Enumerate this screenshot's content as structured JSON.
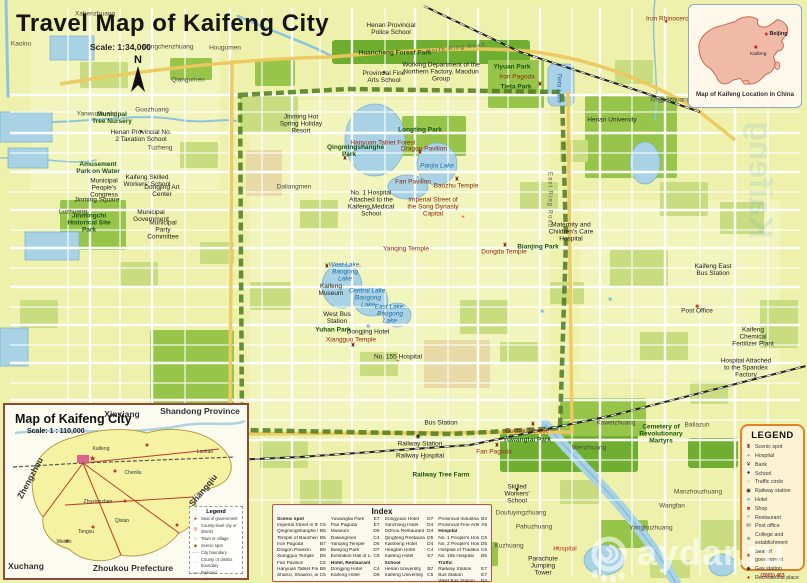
{
  "title": {
    "main": "Travel Map of Kaifeng City",
    "scale": "Scale: 1:34,000",
    "north": "N"
  },
  "china_inset": {
    "caption": "Map of Kaifeng Location in China",
    "beijing": "Beijing",
    "kaifeng": "Kaifeng"
  },
  "city_inset": {
    "title": "Map of Kaifeng City",
    "scale": "Scale: 1 : 110,000",
    "surround": [
      {
        "text": "Xinxiang",
        "x": 122,
        "y": 414
      },
      {
        "text": "Shandong Province",
        "x": 200,
        "y": 411
      },
      {
        "text": "Zhengzhou",
        "x": 30,
        "y": 478,
        "rot": -62
      },
      {
        "text": "Shangqiu",
        "x": 203,
        "y": 490,
        "rot": -50
      },
      {
        "text": "Xuchang",
        "x": 26,
        "y": 566
      },
      {
        "text": "Zhoukou Prefecture",
        "x": 133,
        "y": 568
      }
    ],
    "towns": [
      {
        "text": "Kaifeng",
        "x": 101,
        "y": 449
      },
      {
        "text": "Lankao",
        "x": 205,
        "y": 452
      },
      {
        "text": "Chenliu",
        "x": 133,
        "y": 473
      },
      {
        "text": "Qixian",
        "x": 122,
        "y": 521
      },
      {
        "text": "Tongxu",
        "x": 86,
        "y": 532
      },
      {
        "text": "Weishi",
        "x": 64,
        "y": 542
      },
      {
        "text": "Zhuxianzhen",
        "x": 98,
        "y": 502
      }
    ],
    "legend": {
      "title": "Legend",
      "items": [
        {
          "label": "Seat of government",
          "glyph": "★",
          "color": "#d42c1e"
        },
        {
          "label": "County-level city or district",
          "glyph": "◎",
          "color": "#d42c1e"
        },
        {
          "label": "Town or village",
          "glyph": "○",
          "color": "#555555"
        },
        {
          "label": "Scenic spot",
          "glyph": "◆",
          "color": "#b05a10"
        },
        {
          "label": "City boundary",
          "glyph": "–·–",
          "color": "#888888"
        },
        {
          "label": "County or district boundary",
          "glyph": "···",
          "color": "#888888"
        },
        {
          "label": "Railroad",
          "glyph": "══",
          "color": "#444444"
        },
        {
          "label": "Highway",
          "glyph": "──",
          "color": "#c0392b"
        }
      ]
    }
  },
  "index": {
    "title": "Index",
    "col1": [
      {
        "label": "Scenic spot",
        "cls": "hdr"
      },
      {
        "label": "Imperial Street in the Song Dynasty Capital",
        "ref": "C5"
      },
      {
        "label": "Qingmingshanghe Park",
        "ref": "B5"
      },
      {
        "label": "Temple of Baozheng",
        "ref": "B5"
      },
      {
        "label": "Iron Pagoda",
        "ref": "B7"
      },
      {
        "label": "Dragon Pavilion",
        "ref": "B6"
      },
      {
        "label": "Xiangguo Temple",
        "ref": "D6"
      },
      {
        "label": "Fan Pavilion",
        "ref": "C5"
      },
      {
        "label": "Hanyuan Tablet Forest",
        "ref": "B6"
      },
      {
        "label": "Shanxi, Shaanxi, and Gansu Guild",
        "ref": "C5"
      }
    ],
    "col2": [
      {
        "label": "Yuwangtai Park",
        "ref": "E7"
      },
      {
        "label": "Pan Pagoda",
        "ref": "E7"
      },
      {
        "label": "Museum",
        "ref": "D5"
      },
      {
        "label": "Daliangmen",
        "ref": "C4"
      },
      {
        "label": "Yanqing Temple",
        "ref": "D5"
      },
      {
        "label": "Bianjing Park",
        "ref": "D7"
      },
      {
        "label": "Exhibition Hall of Liu Shaoqi",
        "ref": "C5"
      },
      {
        "label": "Hotel, Restaurant",
        "cls": "hdr"
      },
      {
        "label": "Dongjing Hotel",
        "ref": "C4"
      },
      {
        "label": "Kaifeng Hotel",
        "ref": "D6"
      }
    ],
    "col3": [
      {
        "label": "Dongyuan Hotel",
        "ref": "D7"
      },
      {
        "label": "Yanzhong Hotel",
        "ref": "D4"
      },
      {
        "label": "Dizhou Restaurant",
        "ref": "D4"
      },
      {
        "label": "Qingfeng Restaurant",
        "ref": "D5"
      },
      {
        "label": "Kaisheng Hotel",
        "ref": "D4"
      },
      {
        "label": "Hengfan Hotel",
        "ref": "C4"
      },
      {
        "label": "Kaifeng Hotel",
        "ref": "E7"
      },
      {
        "label": "School",
        "cls": "hdr"
      },
      {
        "label": "Henan University",
        "ref": "B7"
      },
      {
        "label": "Kaifeng University",
        "ref": "C5"
      }
    ],
    "col4": [
      {
        "label": "Provincial Industrial and Commercial School",
        "ref": "B4"
      },
      {
        "label": "Provincial Fine Arts School",
        "ref": "A5"
      },
      {
        "label": "Hospital",
        "cls": "hdr"
      },
      {
        "label": "No. 1 People's Hospital",
        "ref": "C6"
      },
      {
        "label": "No. 2 People's Hospital",
        "ref": "D5"
      },
      {
        "label": "Hospital of Traditional Chinese Medicine",
        "ref": "C6"
      },
      {
        "label": "No. 155 Hospital",
        "ref": "B5"
      },
      {
        "label": "Traffic",
        "cls": "hdr"
      },
      {
        "label": "Railway Station",
        "ref": "E7"
      },
      {
        "label": "Bus Station",
        "ref": "E7"
      },
      {
        "label": "West Bus Station",
        "ref": "D4"
      }
    ]
  },
  "legend": {
    "title": "LEGEND",
    "items": [
      {
        "label": "Scenic spot",
        "glyph": "♜",
        "color": "#8a3318"
      },
      {
        "label": "Hospital",
        "glyph": "+",
        "color": "#d43c2a"
      },
      {
        "label": "Bank",
        "glyph": "¥",
        "color": "#222222"
      },
      {
        "label": "School",
        "glyph": "●",
        "color": "#222222"
      },
      {
        "label": "Traffic circle",
        "glyph": "○",
        "color": "#a8b83a"
      },
      {
        "label": "Railway station",
        "glyph": "◉",
        "color": "#222222"
      },
      {
        "label": "Hotel",
        "glyph": "■",
        "color": "#8fc0dd"
      },
      {
        "label": "Shop",
        "glyph": "■",
        "color": "#cc3322"
      },
      {
        "label": "Restaurant",
        "glyph": "●",
        "color": "#8fc0dd"
      },
      {
        "label": "Post office",
        "glyph": "✉",
        "color": "#444444"
      },
      {
        "label": "College and establishment",
        "glyph": "■",
        "color": "#999999"
      },
      {
        "label": "Seat of government",
        "glyph": "★",
        "color": "#d42c1e"
      },
      {
        "label": "Gas station",
        "glyph": "◆",
        "color": "#333333"
      },
      {
        "label": "Recreational place",
        "glyph": "●",
        "color": "#d42c1e"
      }
    ],
    "note": "(2001) 463"
  },
  "watermark": {
    "text": "aydar.ru"
  },
  "ghost": {
    "text": "Kaifeng"
  },
  "map_labels": [
    {
      "text": "Huancheng Forest Park",
      "x": 395,
      "y": 53,
      "cls": "park"
    },
    {
      "text": "Yiyuan Park",
      "x": 512,
      "y": 67,
      "cls": "park"
    },
    {
      "text": "Iron Pagoda",
      "x": 517,
      "y": 77,
      "cls": "site"
    },
    {
      "text": "Tieta Park",
      "x": 516,
      "y": 87,
      "cls": "park"
    },
    {
      "text": "Longting Park",
      "x": 420,
      "y": 130,
      "cls": "park"
    },
    {
      "text": "Dragon Pavilion",
      "x": 424,
      "y": 149,
      "cls": "site"
    },
    {
      "text": "Panjia Lake",
      "x": 437,
      "y": 166,
      "cls": "water"
    },
    {
      "text": "Fan Pavilion",
      "x": 413,
      "y": 182,
      "cls": "site"
    },
    {
      "text": "Hanyuan Tablet Forest",
      "x": 383,
      "y": 143,
      "cls": "site"
    },
    {
      "text": "Qingmingshanghe Park",
      "x": 349,
      "y": 151,
      "cls": "park",
      "w": 44
    },
    {
      "text": "Amusement Park on Water",
      "x": 98,
      "y": 168,
      "cls": "park",
      "w": 44
    },
    {
      "text": "Jinmingchi Historical Site Park",
      "x": 89,
      "y": 223,
      "cls": "park",
      "w": 46
    },
    {
      "text": "Municipal Tree Nursery",
      "x": 112,
      "y": 118,
      "cls": "park",
      "w": 40
    },
    {
      "text": "Jinming Hot Spring Holiday Resort",
      "x": 301,
      "y": 124,
      "cls": "poi",
      "w": 52
    },
    {
      "text": "Railway Tree Farm",
      "x": 441,
      "y": 475,
      "cls": "park"
    },
    {
      "text": "Guchui Terrace",
      "x": 527,
      "y": 431,
      "cls": "site"
    },
    {
      "text": "Yuwangtai Park",
      "x": 527,
      "y": 440,
      "cls": "park"
    },
    {
      "text": "Bianjing Park",
      "x": 538,
      "y": 247,
      "cls": "park"
    },
    {
      "text": "Cemetery of Revolutionary Martyrs",
      "x": 661,
      "y": 434,
      "cls": "park",
      "w": 54
    },
    {
      "text": "Parachute Jumping Tower",
      "x": 543,
      "y": 566,
      "cls": "poi",
      "w": 40
    },
    {
      "text": "Railway Station",
      "x": 420,
      "y": 444,
      "cls": "poi"
    },
    {
      "text": "Bus Station",
      "x": 441,
      "y": 423,
      "cls": "poi"
    },
    {
      "text": "Railway Hospital",
      "x": 420,
      "y": 456,
      "cls": "poi"
    },
    {
      "text": "Fan Pagoda",
      "x": 494,
      "y": 452,
      "cls": "site"
    },
    {
      "text": "West Lake, Baogong Lake",
      "x": 345,
      "y": 272,
      "cls": "water",
      "w": 40
    },
    {
      "text": "Central Lake, Baogong Lake",
      "x": 368,
      "y": 298,
      "cls": "water",
      "w": 40
    },
    {
      "text": "East Lake, Baogong Lake",
      "x": 390,
      "y": 314,
      "cls": "water",
      "w": 36
    },
    {
      "text": "Yuhan Park",
      "x": 333,
      "y": 330,
      "cls": "park"
    },
    {
      "text": "Tieta Lake",
      "x": 559,
      "y": 88,
      "cls": "water",
      "rot": 90
    },
    {
      "text": "Baozhu Temple",
      "x": 456,
      "y": 186,
      "cls": "site"
    },
    {
      "text": "Dongda Temple",
      "x": 504,
      "y": 252,
      "cls": "site"
    },
    {
      "text": "Xiangguo Temple",
      "x": 351,
      "y": 340,
      "cls": "site"
    },
    {
      "text": "Yanqing Temple",
      "x": 406,
      "y": 249,
      "cls": "site"
    },
    {
      "text": "Municipal Government",
      "x": 151,
      "y": 216,
      "cls": "poi",
      "w": 40
    },
    {
      "text": "Municipal Party Committee",
      "x": 163,
      "y": 230,
      "cls": "poi",
      "w": 44
    },
    {
      "text": "Municipal People's Congress",
      "x": 104,
      "y": 188,
      "cls": "poi",
      "w": 52
    },
    {
      "text": "Jinming Square",
      "x": 97,
      "y": 200,
      "cls": "poi"
    },
    {
      "text": "Henan Provincial No. 2 Taxation School",
      "x": 141,
      "y": 136,
      "cls": "poi",
      "w": 62
    },
    {
      "text": "Kaifeng Skilled Workers' School",
      "x": 147,
      "y": 181,
      "cls": "poi",
      "w": 56
    },
    {
      "text": "Dongjing Art Center",
      "x": 162,
      "y": 191,
      "cls": "poi",
      "w": 40
    },
    {
      "text": "Provincial Fine Arts School",
      "x": 384,
      "y": 77,
      "cls": "poi",
      "w": 48
    },
    {
      "text": "Working Department of the Northern Factory, Maodun Group",
      "x": 441,
      "y": 72,
      "cls": "poi",
      "w": 78
    },
    {
      "text": "Henan Provincial Police School",
      "x": 391,
      "y": 29,
      "cls": "poi",
      "w": 56
    },
    {
      "text": "No. 1 Hospital Attached to the Kaifeng Medical School",
      "x": 371,
      "y": 204,
      "cls": "poi",
      "w": 64
    },
    {
      "text": "Imperial Street of the Song Dynasty Capital",
      "x": 433,
      "y": 207,
      "cls": "site",
      "w": 58
    },
    {
      "text": "Maternity and Children's Care Hospital",
      "x": 571,
      "y": 232,
      "cls": "poi",
      "w": 54
    },
    {
      "text": "Kaifeng East Bus Station",
      "x": 713,
      "y": 270,
      "cls": "poi",
      "w": 46
    },
    {
      "text": "Post Office",
      "x": 697,
      "y": 311,
      "cls": "poi"
    },
    {
      "text": "Kaifeng Chemical Fertilizer Plant",
      "x": 753,
      "y": 337,
      "cls": "poi",
      "w": 50
    },
    {
      "text": "Hospital Attached to the Spandex Factory",
      "x": 746,
      "y": 368,
      "cls": "poi",
      "w": 54
    },
    {
      "text": "Dongjing Hotel",
      "x": 368,
      "y": 332,
      "cls": "poi"
    },
    {
      "text": "Kaifeng Museum",
      "x": 331,
      "y": 290,
      "cls": "poi",
      "w": 30
    },
    {
      "text": "West Bus Station",
      "x": 337,
      "y": 318,
      "cls": "poi",
      "w": 34
    },
    {
      "text": "No. 155 Hospital",
      "x": 398,
      "y": 357,
      "cls": "poi"
    },
    {
      "text": "Skilled Workers' School",
      "x": 517,
      "y": 494,
      "cls": "poi",
      "w": 44
    },
    {
      "text": "Henan University",
      "x": 612,
      "y": 120,
      "cls": "poi"
    },
    {
      "text": "North Ring Road",
      "x": 456,
      "y": 49,
      "cls": "road",
      "rot": -7
    },
    {
      "text": "East Ring Road",
      "x": 549,
      "y": 200,
      "cls": "road",
      "rot": 90
    },
    {
      "text": "Iron Rhinoceros",
      "x": 669,
      "y": 19,
      "cls": "site"
    },
    {
      "text": "Hospital",
      "x": 565,
      "y": 549,
      "cls": "red"
    },
    {
      "text": "Dongchenzhuang",
      "x": 168,
      "y": 47,
      "cls": "vil"
    },
    {
      "text": "Hougumen",
      "x": 225,
      "y": 48,
      "cls": "vil"
    },
    {
      "text": "Qiangumen",
      "x": 188,
      "y": 80,
      "cls": "vil"
    },
    {
      "text": "Xahenzhuang",
      "x": 95,
      "y": 14,
      "cls": "vil"
    },
    {
      "text": "Kaolou",
      "x": 21,
      "y": 44,
      "cls": "vil"
    },
    {
      "text": "Yanwuzhuang",
      "x": 97,
      "y": 114,
      "cls": "vil"
    },
    {
      "text": "Guozhuang",
      "x": 152,
      "y": 110,
      "cls": "vil"
    },
    {
      "text": "Tuzheng",
      "x": 160,
      "y": 148,
      "cls": "vil"
    },
    {
      "text": "Luzhuang",
      "x": 73,
      "y": 212,
      "cls": "vil"
    },
    {
      "text": "Daliangmen",
      "x": 294,
      "y": 187,
      "cls": "vil"
    },
    {
      "text": "Wenzhuang",
      "x": 589,
      "y": 448,
      "cls": "vil"
    },
    {
      "text": "Koweizhuang",
      "x": 616,
      "y": 423,
      "cls": "vil"
    },
    {
      "text": "Baliazun",
      "x": 697,
      "y": 425,
      "cls": "vil"
    },
    {
      "text": "Manzhouzhuang",
      "x": 691,
      "y": 492,
      "cls": "vil",
      "w": 34
    },
    {
      "text": "Wangfan",
      "x": 672,
      "y": 506,
      "cls": "vil"
    },
    {
      "text": "Yanghuzhuang",
      "x": 651,
      "y": 528,
      "cls": "vil"
    },
    {
      "text": "Pahuzhuang",
      "x": 534,
      "y": 527,
      "cls": "vil"
    },
    {
      "text": "Doufuyingzhuang",
      "x": 521,
      "y": 513,
      "cls": "vil"
    },
    {
      "text": "Kuzhuang",
      "x": 509,
      "y": 546,
      "cls": "vil"
    },
    {
      "text": "Xingjiazhuang",
      "x": 670,
      "y": 100,
      "cls": "vil"
    }
  ],
  "map_markers": [
    {
      "glyph": "♜",
      "color": "#7a2a12",
      "x": 420,
      "y": 153
    },
    {
      "glyph": "♜",
      "color": "#7a2a12",
      "x": 540,
      "y": 85
    },
    {
      "glyph": "♜",
      "color": "#7a2a12",
      "x": 497,
      "y": 446
    },
    {
      "glyph": "♜",
      "color": "#7a2a12",
      "x": 345,
      "y": 159
    },
    {
      "glyph": "♜",
      "color": "#7a2a12",
      "x": 327,
      "y": 267
    },
    {
      "glyph": "♜",
      "color": "#7a2a12",
      "x": 353,
      "y": 346
    },
    {
      "glyph": "♜",
      "color": "#7a2a12",
      "x": 457,
      "y": 180
    },
    {
      "glyph": "♜",
      "color": "#7a2a12",
      "x": 505,
      "y": 246
    },
    {
      "glyph": "♜",
      "color": "#7a2a12",
      "x": 533,
      "y": 425
    },
    {
      "glyph": "+",
      "color": "#d42c1e",
      "x": 371,
      "y": 210
    },
    {
      "glyph": "+",
      "color": "#d42c1e",
      "x": 463,
      "y": 218
    },
    {
      "glyph": "+",
      "color": "#d42c1e",
      "x": 398,
      "y": 362
    },
    {
      "glyph": "+",
      "color": "#d42c1e",
      "x": 424,
      "y": 460
    },
    {
      "glyph": "+",
      "color": "#d42c1e",
      "x": 557,
      "y": 549
    },
    {
      "glyph": "◉",
      "color": "#222222",
      "x": 418,
      "y": 437
    },
    {
      "glyph": "●",
      "color": "#cc2211",
      "x": 666,
      "y": 22
    },
    {
      "glyph": "■",
      "color": "#7fb8d8",
      "x": 368,
      "y": 327
    },
    {
      "glyph": "■",
      "color": "#7fb8d8",
      "x": 542,
      "y": 312
    },
    {
      "glyph": "■",
      "color": "#7fb8d8",
      "x": 610,
      "y": 300
    },
    {
      "glyph": "●",
      "color": "#222222",
      "x": 141,
      "y": 132
    },
    {
      "glyph": "●",
      "color": "#222222",
      "x": 384,
      "y": 73
    },
    {
      "glyph": "●",
      "color": "#222222",
      "x": 517,
      "y": 490
    },
    {
      "glyph": "■",
      "color": "#cc3322",
      "x": 697,
      "y": 307
    }
  ]
}
